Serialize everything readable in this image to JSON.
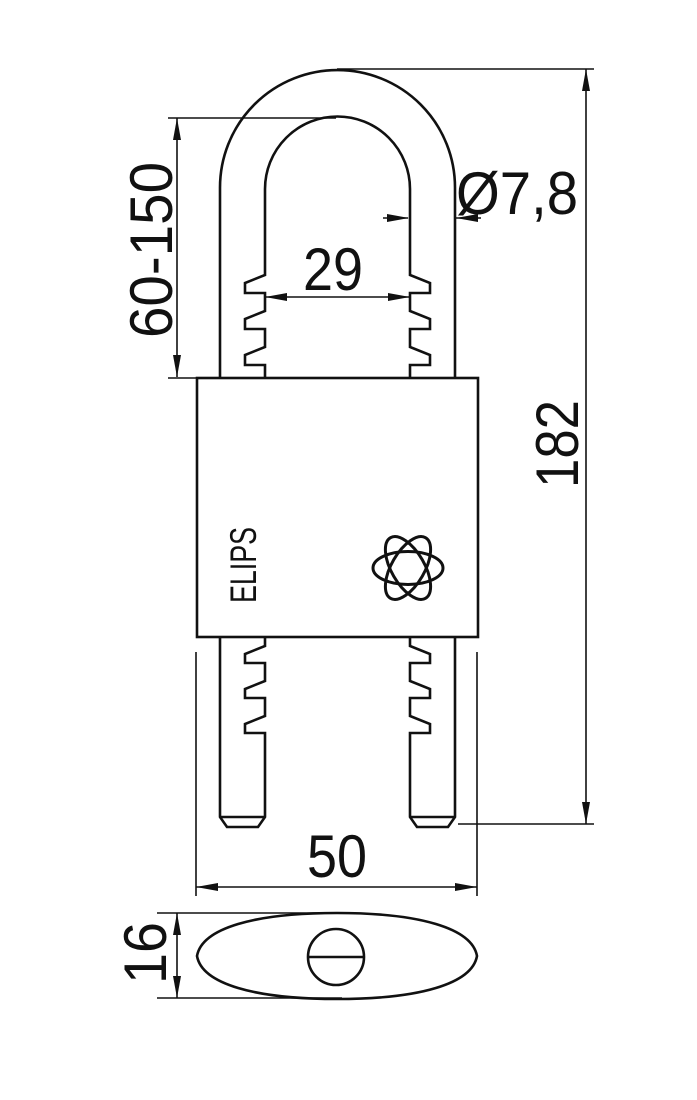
{
  "drawing": {
    "type": "technical-dimension-drawing",
    "subject": "padlock with adjustable ribbed shackle, front view and bottom view",
    "brand": "ELIPS",
    "logo_icon": "atom-logo",
    "colors": {
      "line": "#111111",
      "background": "#ffffff"
    },
    "dimensions": {
      "shackle_clearance": "60-150",
      "shackle_diameter": "Ø7,8",
      "shackle_inner_width": "29",
      "total_height": "182",
      "body_width": "50",
      "body_depth": "16"
    }
  }
}
